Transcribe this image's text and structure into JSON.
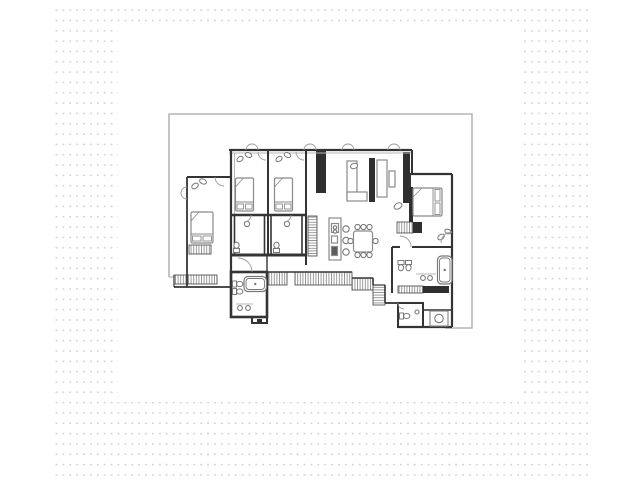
{
  "title": "apartment-floor-plan",
  "colors": {
    "wall": "#343434",
    "dark": "#2f2f2f",
    "furn": "#8a8a8a",
    "fix": "#787878",
    "light": "#b5b5b5",
    "shell": "#a6a6a6",
    "hatch": "#8e8e8e",
    "dot": "#d4d4d4",
    "white": "#ffffff"
  },
  "background": {
    "dots": {
      "x": 52,
      "y": 4,
      "w": 537,
      "h": 473
    },
    "canvas": {
      "x": 118,
      "y": 30,
      "w": 404,
      "h": 372
    }
  },
  "plan": {
    "shell": {
      "n": "building-shell-outline",
      "points": "169,277 169,114 472,114 472,328 445,328",
      "extra": [
        [
          169,
          277,
          213,
          277
        ]
      ]
    },
    "walls": [
      [
        229,
        150,
        412,
        150,
        2.2,
        0
      ],
      [
        229,
        153,
        412,
        153,
        0.9,
        1
      ],
      [
        231,
        150,
        231,
        287,
        2.2,
        0
      ],
      [
        187,
        177,
        231,
        177,
        2,
        0
      ],
      [
        187,
        177,
        187,
        287,
        1.8,
        0
      ],
      [
        174,
        287,
        231,
        287,
        1.8,
        0
      ],
      [
        174,
        275,
        174,
        287,
        1.2,
        0
      ],
      [
        234.5,
        153,
        234.5,
        215,
        1,
        1
      ],
      [
        268,
        150,
        268,
        255,
        2,
        0
      ],
      [
        306,
        150,
        306,
        265,
        2,
        0
      ],
      [
        231,
        215,
        306,
        215,
        2.6,
        0
      ],
      [
        231,
        255,
        306,
        255,
        3,
        0
      ],
      [
        267,
        255,
        267,
        272,
        1.4,
        0
      ],
      [
        412,
        150,
        412,
        174,
        2,
        0
      ],
      [
        410,
        174,
        452,
        174,
        2.2,
        0
      ],
      [
        410,
        174,
        410,
        188,
        2,
        0
      ],
      [
        452,
        174,
        452,
        327,
        2.2,
        0
      ],
      [
        398,
        327,
        452,
        327,
        2.2,
        0
      ],
      [
        423,
        303,
        423,
        327,
        1.4,
        0
      ],
      [
        423,
        310,
        452,
        310,
        1.4,
        0
      ],
      [
        392,
        247,
        400,
        247,
        2,
        0
      ],
      [
        412,
        247,
        452,
        247,
        2,
        0
      ],
      [
        392,
        247,
        392,
        293,
        2,
        0
      ],
      [
        267,
        272,
        352,
        272,
        1.6,
        0
      ],
      [
        352,
        278,
        373,
        278,
        1.6,
        0
      ],
      [
        373,
        278,
        373,
        285,
        1.6,
        0
      ],
      [
        373,
        285,
        385,
        285,
        1.2,
        0
      ],
      [
        385,
        285,
        385,
        303,
        1.6,
        0
      ],
      [
        385,
        303,
        398,
        303,
        1.8,
        0
      ],
      [
        236,
        304,
        253,
        304,
        1,
        1
      ],
      [
        416,
        274,
        436,
        274,
        1,
        1
      ],
      [
        350,
        162,
        350,
        199,
        1,
        1
      ],
      [
        384.5,
        161,
        384.5,
        196,
        1,
        1
      ]
    ],
    "dark_rects": [
      {
        "n": "closet-wall-column",
        "x": 316,
        "y": 151,
        "w": 10,
        "h": 42
      },
      {
        "n": "tv-partition",
        "x": 369,
        "y": 158,
        "w": 6,
        "h": 44
      },
      {
        "n": "living-east-wall",
        "x": 403,
        "y": 152,
        "w": 7,
        "h": 51
      },
      {
        "n": "master-closet-bar",
        "x": 409,
        "y": 187,
        "w": 4,
        "h": 35
      },
      {
        "n": "master-bath-counter-dark",
        "x": 423,
        "y": 286,
        "w": 26,
        "h": 7
      },
      {
        "n": "dresser-dark",
        "x": 413,
        "y": 222,
        "w": 9,
        "h": 11
      },
      {
        "n": "bath-detail-dark",
        "x": 257,
        "y": 319,
        "w": 5,
        "h": 4
      }
    ],
    "hatch_rects": [
      {
        "n": "wardrobe-bedroom-left",
        "x": 189,
        "y": 245,
        "w": 22,
        "h": 9,
        "dir": "v"
      },
      {
        "n": "closet-bottom-left",
        "x": 174,
        "y": 275,
        "w": 43,
        "h": 9,
        "dir": "v"
      },
      {
        "n": "pantry-column",
        "x": 308,
        "y": 216,
        "w": 9,
        "h": 40,
        "dir": "h"
      },
      {
        "n": "dresser-hatch",
        "x": 397,
        "y": 222,
        "w": 16,
        "h": 11,
        "dir": "v"
      },
      {
        "n": "hall-closet-a",
        "x": 268,
        "y": 272,
        "w": 19,
        "h": 13,
        "dir": "v"
      },
      {
        "n": "hall-closet-b",
        "x": 295,
        "y": 272,
        "w": 57,
        "h": 13,
        "dir": "v"
      },
      {
        "n": "hall-closet-c",
        "x": 352,
        "y": 278,
        "w": 21,
        "h": 12,
        "dir": "v"
      },
      {
        "n": "corridor-bend-closet",
        "x": 373,
        "y": 285,
        "w": 12,
        "h": 20,
        "dir": "h"
      },
      {
        "n": "master-bath-counter-hatch",
        "x": 398,
        "y": 286,
        "w": 25,
        "h": 7,
        "dir": "v"
      }
    ],
    "room_rects": [
      {
        "n": "bathroom-2",
        "x": 234.5,
        "y": 215,
        "w": 30,
        "h": 40,
        "s": 1.6
      },
      {
        "n": "bathroom-3",
        "x": 271,
        "y": 215,
        "w": 31,
        "h": 40,
        "s": 1.6
      },
      {
        "n": "central-bathroom",
        "x": 231,
        "y": 272,
        "w": 36,
        "h": 45,
        "s": 2.6
      },
      {
        "n": "central-bathroom-bump",
        "x": 252,
        "y": 317,
        "w": 15,
        "h": 6,
        "s": 2
      },
      {
        "n": "wc-room",
        "x": 398,
        "y": 303,
        "w": 25,
        "h": 24,
        "s": 2
      }
    ],
    "furn_rects": [
      {
        "n": "sofa-left",
        "x": 347,
        "y": 161,
        "w": 10,
        "h": 39
      },
      {
        "n": "sofa-chaise",
        "x": 347,
        "y": 192,
        "w": 20,
        "h": 9
      },
      {
        "n": "sofa-right",
        "x": 377,
        "y": 160,
        "w": 10,
        "h": 37
      },
      {
        "n": "coffee-table",
        "x": 389,
        "y": 171,
        "w": 6,
        "h": 16
      },
      {
        "n": "kitchen-island",
        "x": 329,
        "y": 218,
        "w": 12,
        "h": 42
      },
      {
        "n": "island-sink-unit",
        "x": 331.5,
        "y": 223.5,
        "w": 7,
        "h": 9
      },
      {
        "n": "island-cooktop",
        "x": 331.5,
        "y": 236,
        "w": 6,
        "h": 7
      },
      {
        "n": "island-appliance",
        "x": 331.5,
        "y": 246.5,
        "w": 6,
        "h": 9,
        "f": "#5a5a5a"
      },
      {
        "n": "washing-machine",
        "x": 430,
        "y": 311,
        "w": 18,
        "h": 15
      },
      {
        "n": "dining-table",
        "x": 353.5,
        "y": 231,
        "w": 19,
        "h": 21,
        "rx": 2.5
      }
    ],
    "circles": [
      {
        "n": "bar-stool",
        "cx": 346,
        "cy": 229,
        "r": 3.2
      },
      {
        "n": "bar-stool",
        "cx": 346,
        "cy": 240.5,
        "r": 3.2
      },
      {
        "n": "bar-stool",
        "cx": 346,
        "cy": 252,
        "r": 3.2
      },
      {
        "n": "sink-bath-2",
        "cx": 247,
        "cy": 224,
        "r": 2.6
      },
      {
        "n": "sink-bath-3",
        "cx": 287,
        "cy": 224,
        "r": 2.6
      },
      {
        "n": "sink-central-1",
        "cx": 240,
        "cy": 308,
        "r": 2.4
      },
      {
        "n": "sink-central-2",
        "cx": 248,
        "cy": 308,
        "r": 2.4
      },
      {
        "n": "sink-master-1",
        "cx": 423,
        "cy": 278,
        "r": 2.4
      },
      {
        "n": "sink-master-2",
        "cx": 430,
        "cy": 278,
        "r": 2.4
      },
      {
        "n": "sink-wc",
        "cx": 417,
        "cy": 312,
        "r": 2
      },
      {
        "n": "washer-drum",
        "cx": 439,
        "cy": 318.5,
        "r": 4.2
      },
      {
        "n": "island-tap",
        "cx": 335,
        "cy": 227.5,
        "r": 1.7
      },
      {
        "n": "island-tap",
        "cx": 335,
        "cy": 231.5,
        "r": 1.7
      },
      {
        "n": "dining-chair",
        "cx": 357.5,
        "cy": 227,
        "r": 2.6
      },
      {
        "n": "dining-chair",
        "cx": 363.5,
        "cy": 227,
        "r": 2.6
      },
      {
        "n": "dining-chair",
        "cx": 369.5,
        "cy": 227,
        "r": 2.6
      },
      {
        "n": "dining-chair",
        "cx": 357.5,
        "cy": 255,
        "r": 2.6
      },
      {
        "n": "dining-chair",
        "cx": 363.5,
        "cy": 255,
        "r": 2.6
      },
      {
        "n": "dining-chair",
        "cx": 369.5,
        "cy": 255,
        "r": 2.6
      },
      {
        "n": "dining-chair",
        "cx": 350.5,
        "cy": 241,
        "r": 2.6
      },
      {
        "n": "dining-chair",
        "cx": 375.5,
        "cy": 241,
        "r": 2.6
      }
    ],
    "ellipses": [
      {
        "n": "lamp",
        "cx": 195,
        "cy": 186,
        "rx": 3.6,
        "ry": 2.4,
        "rot": -35
      },
      {
        "n": "lamp",
        "cx": 203,
        "cy": 181.5,
        "rx": 3.6,
        "ry": 2.4,
        "rot": 25
      },
      {
        "n": "lamp",
        "cx": 240,
        "cy": 159,
        "rx": 3.4,
        "ry": 2.3,
        "rot": -35
      },
      {
        "n": "lamp",
        "cx": 248.5,
        "cy": 155,
        "rx": 3.4,
        "ry": 2.3,
        "rot": 25
      },
      {
        "n": "lamp",
        "cx": 279,
        "cy": 159,
        "rx": 3.4,
        "ry": 2.3,
        "rot": -35
      },
      {
        "n": "lamp",
        "cx": 287.5,
        "cy": 155,
        "rx": 3.4,
        "ry": 2.3,
        "rot": 25
      },
      {
        "n": "plant",
        "cx": 398,
        "cy": 206,
        "rx": 4.2,
        "ry": 2.8,
        "rot": -30
      },
      {
        "n": "lamp",
        "cx": 441,
        "cy": 237,
        "rx": 3.6,
        "ry": 2.4,
        "rot": -35
      },
      {
        "n": "lamp",
        "cx": 448,
        "cy": 231.5,
        "rx": 3.3,
        "ry": 2.2,
        "rot": 25
      },
      {
        "n": "sofa-cushion",
        "cx": 354,
        "cy": 166,
        "rx": 3.6,
        "ry": 2.6,
        "rot": -20
      }
    ],
    "arcs": [
      {
        "n": "terrace-door-arc",
        "cx": 252,
        "cy": 150,
        "r": 6,
        "a1": 180,
        "a2": 360
      },
      {
        "n": "terrace-door-arc",
        "cx": 310,
        "cy": 150,
        "r": 6,
        "a1": 180,
        "a2": 360
      },
      {
        "n": "terrace-door-arc",
        "cx": 348,
        "cy": 150,
        "r": 6,
        "a1": 180,
        "a2": 360
      },
      {
        "n": "terrace-door-arc",
        "cx": 394,
        "cy": 150,
        "r": 6,
        "a1": 180,
        "a2": 360
      },
      {
        "n": "window-arc",
        "cx": 187,
        "cy": 193,
        "r": 6,
        "a1": 90,
        "a2": 270
      },
      {
        "n": "door-arc-bedroom-left",
        "cx": 224,
        "cy": 177,
        "r": 9,
        "a1": 90,
        "a2": 180
      },
      {
        "n": "door-arc-bedroom-2",
        "cx": 266,
        "cy": 152,
        "r": 8,
        "a1": 90,
        "a2": 180
      },
      {
        "n": "door-arc-bedroom-3",
        "cx": 304,
        "cy": 152,
        "r": 8,
        "a1": 90,
        "a2": 180
      },
      {
        "n": "door-arc-bath-2",
        "cx": 244,
        "cy": 215,
        "r": 7,
        "a1": 0,
        "a2": 90
      },
      {
        "n": "door-arc-bath-3",
        "cx": 284,
        "cy": 215,
        "r": 7,
        "a1": 0,
        "a2": 90
      },
      {
        "n": "door-arc-entry",
        "cx": 238,
        "cy": 272,
        "r": 14,
        "a1": 270,
        "a2": 360
      },
      {
        "n": "door-arc-master-bedroom",
        "cx": 400,
        "cy": 247,
        "r": 11,
        "a1": 270,
        "a2": 360
      },
      {
        "n": "door-arc-master-right",
        "cx": 452,
        "cy": 243,
        "r": 11,
        "a1": 180,
        "a2": 270
      },
      {
        "n": "door-arc-wc",
        "cx": 404,
        "cy": 303,
        "r": 6,
        "a1": 90,
        "a2": 180
      }
    ],
    "beds": [
      {
        "n": "bed-left",
        "x": 191,
        "y": 212,
        "w": 22,
        "h": 31,
        "head": "bottom"
      },
      {
        "n": "bed-2",
        "x": 235.5,
        "y": 178,
        "w": 18,
        "h": 33,
        "head": "bottom"
      },
      {
        "n": "bed-3",
        "x": 274.5,
        "y": 178,
        "w": 18,
        "h": 33,
        "head": "bottom"
      },
      {
        "n": "bed-master",
        "x": 413,
        "y": 188,
        "w": 29,
        "h": 28,
        "head": "right"
      }
    ],
    "tubs": [
      {
        "n": "bathtub-central",
        "x": 244,
        "y": 276.5,
        "w": 22.5,
        "h": 15
      },
      {
        "n": "bathtub-master",
        "x": 437.5,
        "y": 256,
        "w": 14.5,
        "h": 28
      }
    ],
    "toilets": [
      {
        "n": "toilet-bath-2",
        "x": 236.5,
        "y": 250.5,
        "rot": 0
      },
      {
        "n": "toilet-bath-3",
        "x": 276.5,
        "y": 250.5,
        "rot": 0
      },
      {
        "n": "toilet-central",
        "x": 234.5,
        "y": 284,
        "rot": 90
      },
      {
        "n": "bidet-central",
        "x": 234.5,
        "y": 291.5,
        "rot": 90
      },
      {
        "n": "toilet-master-1",
        "x": 401,
        "y": 262.5,
        "rot": 180
      },
      {
        "n": "toilet-master-2",
        "x": 408.5,
        "y": 262.5,
        "rot": 180
      },
      {
        "n": "toilet-wc",
        "x": 401.5,
        "y": 316,
        "rot": 90
      }
    ]
  }
}
